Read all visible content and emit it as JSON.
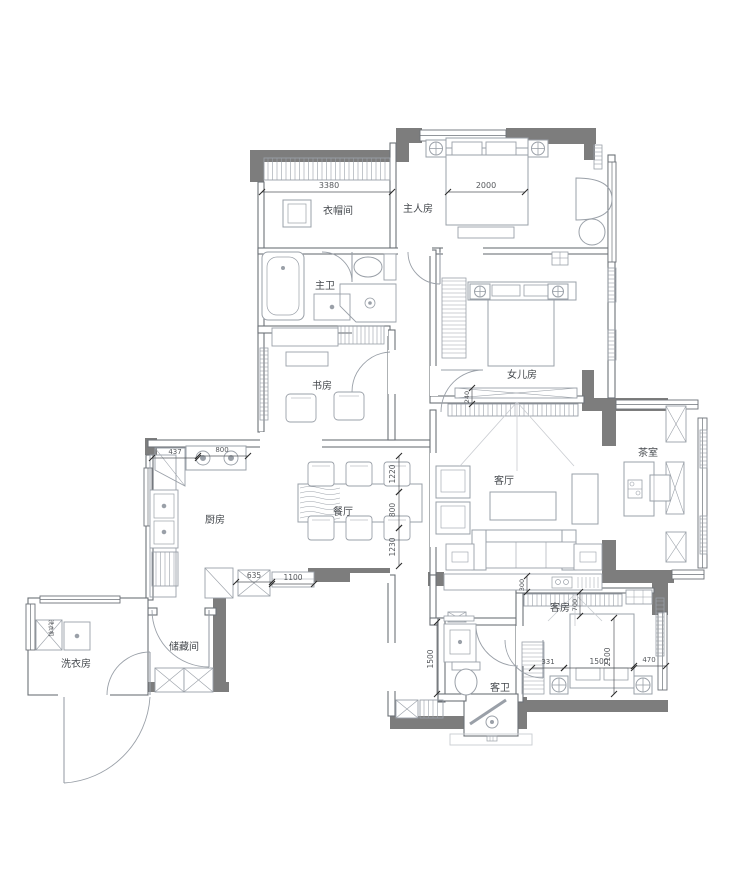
{
  "colors": {
    "wall": "#7d7d7d",
    "thin_wall": "#6d7278",
    "furniture": "#9aa0a8",
    "light_line": "#c9ccd1",
    "text": "#44484d",
    "dim_text": "#55585c",
    "background": "#ffffff"
  },
  "rooms": {
    "cloakroom": {
      "label": "衣帽间"
    },
    "master": {
      "label": "主人房"
    },
    "master_bath": {
      "label": "主卫"
    },
    "study": {
      "label": "书房"
    },
    "daughter": {
      "label": "女儿房"
    },
    "living": {
      "label": "客厅"
    },
    "tea": {
      "label": "茶室"
    },
    "kitchen": {
      "label": "厨房"
    },
    "dining": {
      "label": "餐厅"
    },
    "laundry": {
      "label": "洗衣房"
    },
    "storage": {
      "label": "储藏间"
    },
    "guest": {
      "label": "客房"
    },
    "guest_bath": {
      "label": "客卫"
    },
    "washer": {
      "label": "洗衣机"
    }
  },
  "dims": {
    "cloak_w": "3380",
    "bed_w": "2000",
    "fridge_w": "437",
    "stove_w": "800",
    "din_a": "1220",
    "din_b": "800",
    "din_c": "1230",
    "cab_a": "635",
    "cab_b": "1100",
    "tv_d": "240",
    "bar_d": "300",
    "gb_h": "1500",
    "gr_top": "700",
    "gr_h": "2100",
    "gr_a": "331",
    "gr_b": "1500",
    "gr_c": "470"
  }
}
